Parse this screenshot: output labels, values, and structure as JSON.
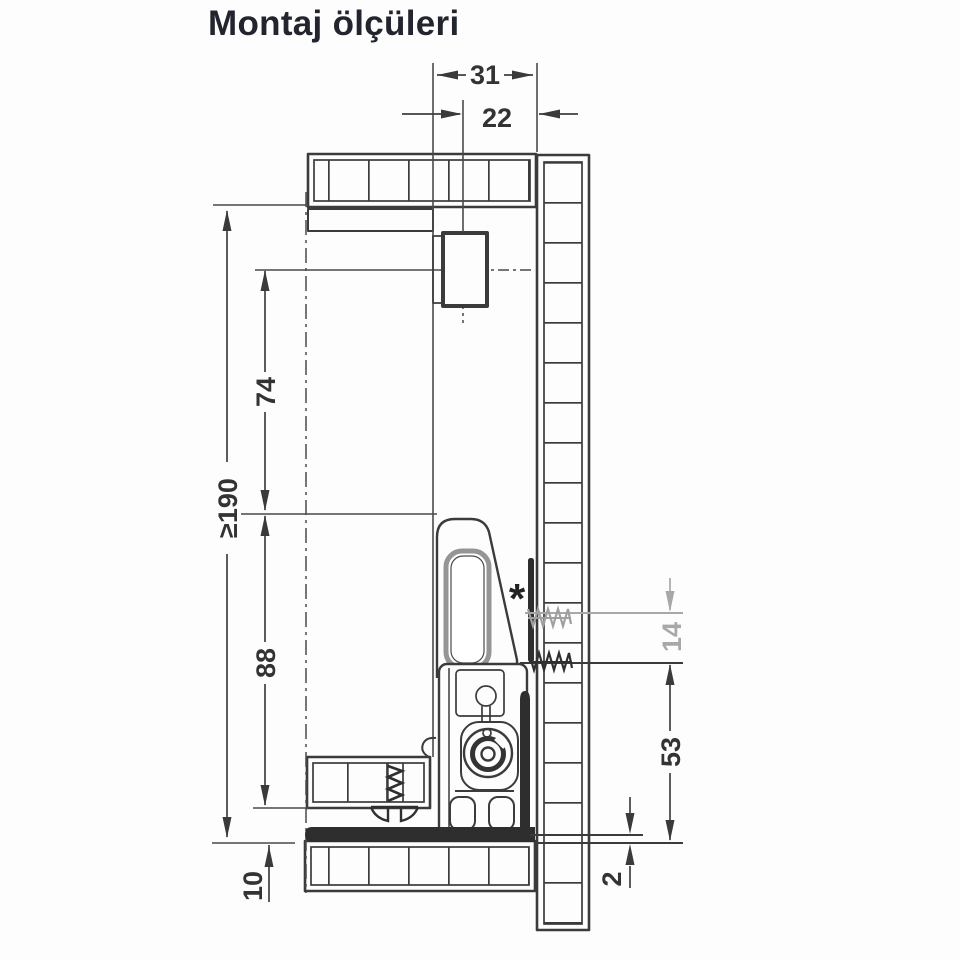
{
  "title": "Montaj ölçüleri",
  "diagram": {
    "dimensions": {
      "top_width": "31",
      "top_offset": "22",
      "interior_height": "≥190",
      "bracket_center_height": "74",
      "runner_height": "88",
      "bottom_offset": "10",
      "screw_gap": "14",
      "lower_screw_height": "53",
      "bottom_clearance": "2"
    },
    "footnote_marker": "*"
  },
  "colors": {
    "line": "#3b3b3b",
    "muted_gray": "#a8a8a8",
    "title_text": "#23252e",
    "background": "#fdfdfd"
  }
}
